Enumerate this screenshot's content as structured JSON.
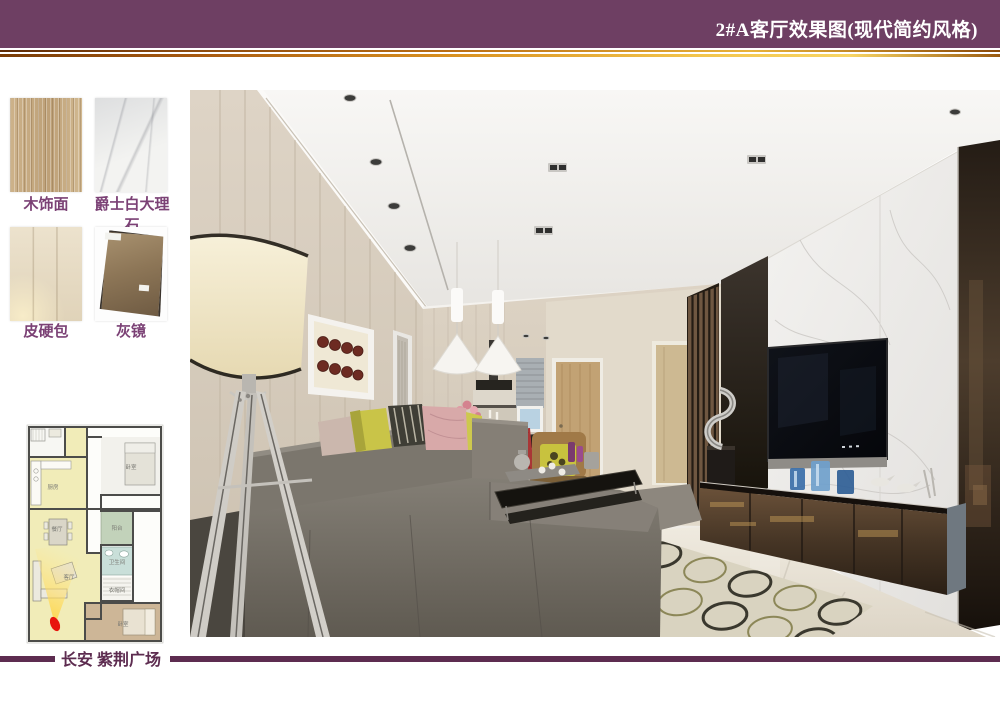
{
  "header": {
    "title": "2#A客厅效果图(现代简约风格)"
  },
  "materials": {
    "items": [
      {
        "label": "木饰面"
      },
      {
        "label": "爵士白大理石"
      },
      {
        "label": "皮硬包"
      },
      {
        "label": "灰镜"
      }
    ]
  },
  "floor_plan": {
    "rooms": [
      {
        "label": "厨房"
      },
      {
        "label": "餐厅"
      },
      {
        "label": "客厅"
      },
      {
        "label": "卧室"
      },
      {
        "label": "阳台"
      },
      {
        "label": "卫生间"
      },
      {
        "label": "衣帽间"
      },
      {
        "label": "卧室"
      }
    ]
  },
  "footer": {
    "project_name": "长安 紫荆广场"
  },
  "colors": {
    "header_bg": "#6e3f63",
    "accent_gold": "#e8b23a",
    "label_purple": "#7b4175",
    "footer_purple": "#5d2c50",
    "camera_marker": "#e8150d",
    "plan_highlight": "#f1ecb8"
  }
}
